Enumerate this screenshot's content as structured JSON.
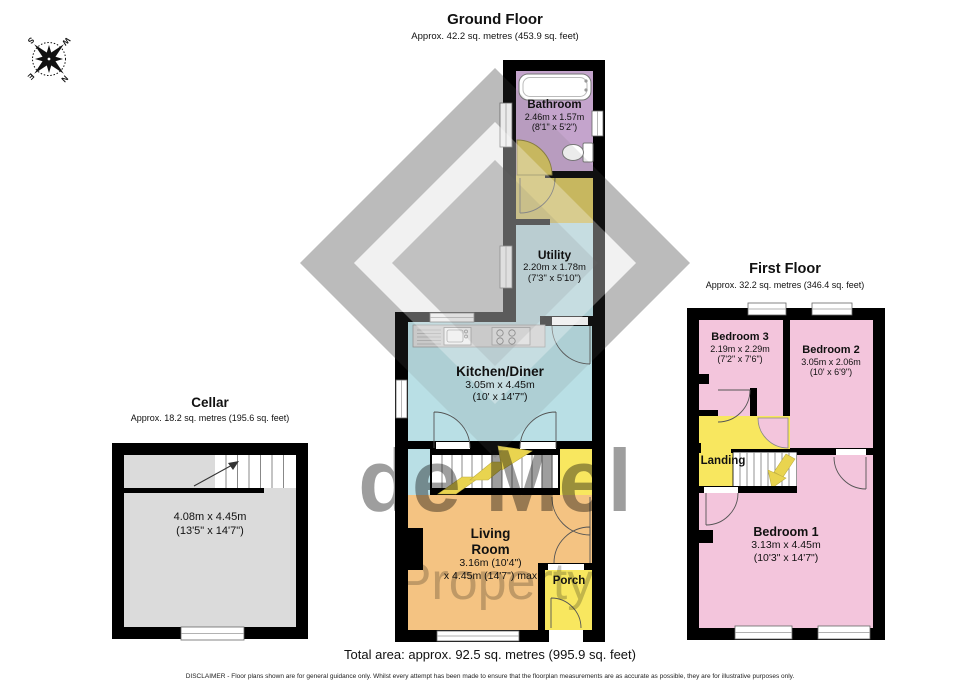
{
  "compass": {
    "north": "N",
    "east": "E",
    "south": "S",
    "west": "W"
  },
  "watermark": {
    "line1": "de Mel",
    "line2": "Property"
  },
  "ground_floor": {
    "title": "Ground Floor",
    "subtitle": "Approx. 42.2 sq. metres (453.9 sq. feet)",
    "rooms": {
      "bathroom": {
        "name": "Bathroom",
        "dims_m": "2.46m x 1.57m",
        "dims_ft": "(8'1\" x 5'2\")"
      },
      "utility": {
        "name": "Utility",
        "dims_m": "2.20m x 1.78m",
        "dims_ft": "(7'3\" x 5'10\")"
      },
      "kitchen": {
        "name": "Kitchen/Diner",
        "dims_m": "3.05m x 4.45m",
        "dims_ft": "(10' x 14'7\")"
      },
      "living": {
        "name_line1": "Living",
        "name_line2": "Room",
        "dims_line1": "3.16m (10'4\")",
        "dims_line2": "x 4.45m (14'7\") max"
      },
      "porch": {
        "name": "Porch"
      }
    }
  },
  "cellar": {
    "title": "Cellar",
    "subtitle": "Approx. 18.2 sq. metres (195.6 sq. feet)",
    "room": {
      "dims_m": "4.08m x 4.45m",
      "dims_ft": "(13'5\" x 14'7\")"
    }
  },
  "first_floor": {
    "title": "First Floor",
    "subtitle": "Approx. 32.2 sq. metres (346.4 sq. feet)",
    "rooms": {
      "bedroom3": {
        "name": "Bedroom 3",
        "dims_m": "2.19m x 2.29m",
        "dims_ft": "(7'2\" x 7'6\")"
      },
      "bedroom2": {
        "name": "Bedroom 2",
        "dims_m": "3.05m x 2.06m",
        "dims_ft": "(10' x 6'9\")"
      },
      "landing": {
        "name": "Landing"
      },
      "bedroom1": {
        "name": "Bedroom 1",
        "dims_m": "3.13m x 4.45m",
        "dims_ft": "(10'3\" x 14'7\")"
      }
    }
  },
  "footer": {
    "total_area": "Total area: approx. 92.5 sq. metres (995.9 sq. feet)",
    "disclaimer": "DISCLAIMER -  Floor plans shown are for general guidance only. Whilst every attempt has been made to ensure that the floorplan measurements are as accurate as possible, they are for illustrative purposes only."
  },
  "colors": {
    "wall": "#000000",
    "bathroom": "#C4A4CC",
    "door_gold": "#D6C35C",
    "cyan_room": "#B9DFE5",
    "living_orange": "#F4C382",
    "yellow_room": "#F8E75F",
    "bedroom_pink": "#F3C5DC",
    "cellar_gray": "#DBDBDB",
    "watermark_gray": "#C7C7C7",
    "arrow_yellow": "#E9D44F"
  }
}
